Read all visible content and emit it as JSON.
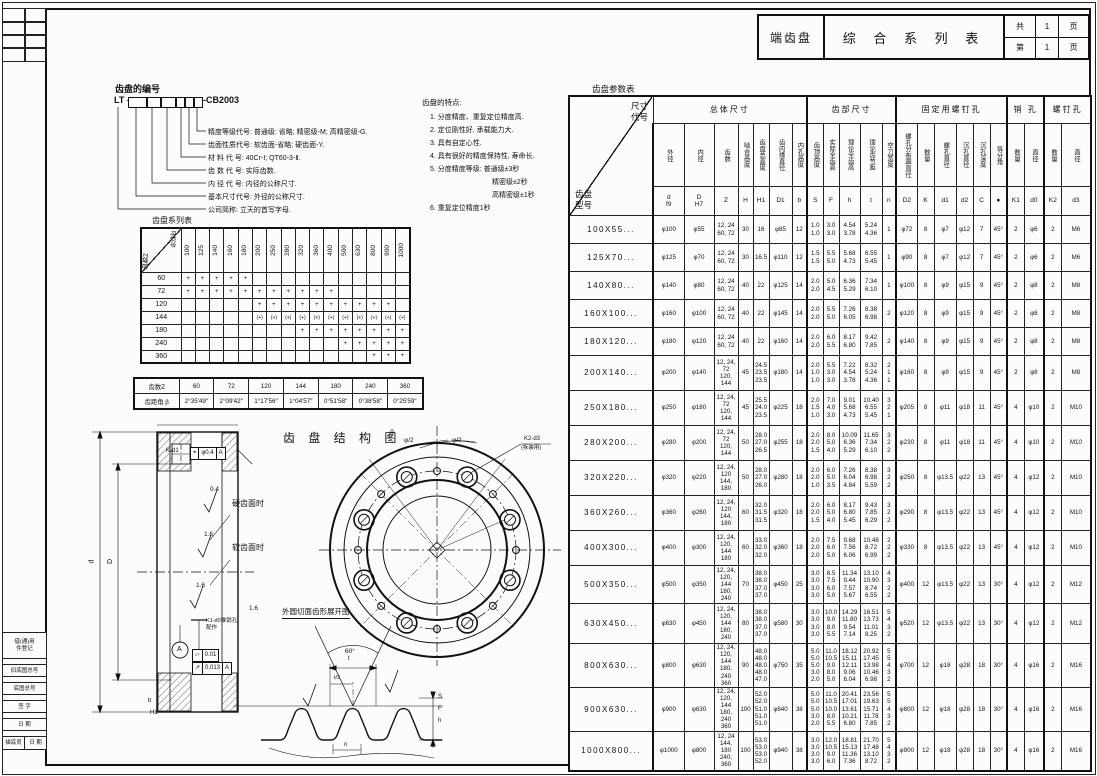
{
  "title_block": {
    "part_name": "端齿盘",
    "title": "综 合 系 列 表",
    "pages_total_prefix": "共",
    "pages_total_num": "1",
    "pages_total_suffix": "页",
    "page_prefix": "第",
    "page_num": "1",
    "page_suffix": "页"
  },
  "numbering": {
    "title": "齿盘的编号",
    "code_prefix": "LT -",
    "code_suffix": "-CB2003",
    "legend": [
      {
        "text": "精度等级代号: 普通级: 省略; 精密级-M; 高精密级-G."
      },
      {
        "text": "齿面性质代号: 软齿面-省略; 硬齿面-Y."
      },
      {
        "text": "材 料 代 号: 40Cr-Ⅰ; QT60-3-Ⅱ."
      },
      {
        "text": "齿 数 代 号: 实际齿数."
      },
      {
        "text": "内 径 代 号: 内径的公称尺寸."
      },
      {
        "text": "基本尺寸代号: 外径的公称尺寸."
      },
      {
        "text": "公司简称: 立天的首写字母."
      }
    ]
  },
  "features": {
    "title": "齿盘的特点:",
    "items": [
      {
        "text": "1. 分度精度、重复定位精度高.",
        "indent": 0
      },
      {
        "text": "2. 定位刚性好, 承载能力大.",
        "indent": 0
      },
      {
        "text": "3. 具有自定心性.",
        "indent": 0
      },
      {
        "text": "4. 具有很好的精度保持性, 寿命长.",
        "indent": 0
      },
      {
        "text": "5. 分度精度等级: 普通级±3秒",
        "indent": 0
      },
      {
        "text": "精密级±2秒",
        "indent": 1
      },
      {
        "text": "高精密级±1秒",
        "indent": 1
      },
      {
        "text": "6. 重复定位精度1秒",
        "indent": 0
      }
    ]
  },
  "series_table": {
    "title": "齿盘系列表",
    "corner_top": "外径d",
    "corner_bottom": "齿数Z",
    "columns": [
      "100",
      "125",
      "140",
      "160",
      "180",
      "200",
      "250",
      "280",
      "320",
      "360",
      "400",
      "500",
      "630",
      "800",
      "900",
      "1000"
    ],
    "rows": [
      {
        "z": "60",
        "marks": [
          "+",
          "+",
          "+",
          "+",
          "+",
          "",
          "",
          "",
          "",
          "",
          "",
          "",
          "",
          "",
          "",
          ""
        ]
      },
      {
        "z": "72",
        "marks": [
          "+",
          "+",
          "+",
          "+",
          "+",
          "+",
          "+",
          "+",
          "+",
          "+",
          "+",
          "",
          "",
          "",
          "",
          ""
        ]
      },
      {
        "z": "120",
        "marks": [
          "",
          "",
          "",
          "",
          "",
          "+",
          "+",
          "+",
          "+",
          "+",
          "+",
          "+",
          "+",
          "+",
          "+",
          ""
        ]
      },
      {
        "z": "144",
        "marks": [
          "",
          "",
          "",
          "",
          "",
          "(+)",
          "(+)",
          "(+)",
          "(+)",
          "(+)",
          "(+)",
          "(+)",
          "(+)",
          "(+)",
          "(+)",
          "(+)"
        ]
      },
      {
        "z": "180",
        "marks": [
          "",
          "",
          "",
          "",
          "",
          "",
          "",
          "",
          "+",
          "+",
          "+",
          "+",
          "+",
          "+",
          "+",
          "+"
        ]
      },
      {
        "z": "240",
        "marks": [
          "",
          "",
          "",
          "",
          "",
          "",
          "",
          "",
          "",
          "",
          "",
          "+",
          "+",
          "+",
          "+",
          "+"
        ]
      },
      {
        "z": "360",
        "marks": [
          "",
          "",
          "",
          "",
          "",
          "",
          "",
          "",
          "",
          "",
          "",
          "",
          "",
          "+",
          "+",
          "+"
        ]
      }
    ]
  },
  "angle_table": {
    "header_label": "齿数Z",
    "row_label": "齿距角 β",
    "columns": [
      "60",
      "72",
      "120",
      "144",
      "180",
      "240",
      "360"
    ],
    "values": [
      "2°35′49″",
      "2°09′42″",
      "1°17′56″",
      "1°04′57″",
      "0°51′58″",
      "0°38′58″",
      "0°25′59″"
    ]
  },
  "structure_fig": {
    "title": "齿 盘 结 构 图",
    "theta": "θ",
    "phi_left": "φ/2",
    "phi_right": "φ/2",
    "callout_line1": "K2-d3",
    "callout_line2": "(拆装用)"
  },
  "side_view": {
    "callout_kd1": "K-d1",
    "pos_tol_sym": "⌖",
    "pos_tol_val": "φ0.4",
    "pos_tol_datum": "A",
    "rough_hard": "0.4",
    "label_hard": "硬齿面时",
    "rough_soft": "1.6",
    "label_soft": "软齿面时",
    "rough_3": "1.6",
    "pin_note_1": "K1-d0锥销孔",
    "pin_note_2": "配作",
    "datum_label": "A",
    "flat_sym": "▱",
    "flat_val": "0.01",
    "runout_sym": "↗",
    "runout_val": "0.013",
    "runout_datum": "A",
    "dim_d": "d",
    "dim_D": "D",
    "dim_b": "b",
    "dim_H1": "H1"
  },
  "development_fig": {
    "title": "外圆切面齿形展开图",
    "rough": "1.6",
    "angle": "60°",
    "dim_t": "t",
    "dim_t2": "t/2",
    "dim_n": "n",
    "dim_S": "S",
    "dim_F": "F",
    "dim_h": "h"
  },
  "param_table": {
    "title": "齿盘参数表",
    "corner_top": "尺寸\n代号",
    "corner_bottom": "齿盘\n型号",
    "groups": [
      {
        "label": "总体尺寸",
        "span": 7
      },
      {
        "label": "齿部尺寸",
        "span": 5
      },
      {
        "label": "固定用螺钉孔",
        "span": 6
      },
      {
        "label": "销 孔",
        "span": 2
      },
      {
        "label": "螺钉孔",
        "span": 2
      }
    ],
    "columns": [
      {
        "name": "外径",
        "sym": "d\nf9",
        "key": "d",
        "w": 31
      },
      {
        "name": "内径",
        "sym": "D\nH7",
        "key": "D",
        "w": 30
      },
      {
        "name": "齿数",
        "sym": "Z",
        "key": "Z",
        "w": 24
      },
      {
        "name": "啮合高度",
        "sym": "H",
        "key": "H",
        "w": 15
      },
      {
        "name": "齿盘总高度",
        "sym": "H1",
        "key": "H1",
        "w": 16
      },
      {
        "name": "齿内缘直径",
        "sym": "D1",
        "key": "D1",
        "w": 23
      },
      {
        "name": "内孔高度",
        "sym": "b",
        "key": "b",
        "w": 15
      },
      {
        "name": "齿顶高度",
        "sym": "S",
        "key": "S",
        "w": 16
      },
      {
        "name": "实际全齿高",
        "sym": "F",
        "key": "F",
        "w": 16
      },
      {
        "name": "理论全齿高",
        "sym": "h",
        "key": "h",
        "w": 21
      },
      {
        "name": "理论齿节距",
        "sym": "t",
        "key": "t",
        "w": 22
      },
      {
        "name": "空刀宽度",
        "sym": "n",
        "key": "n",
        "w": 14
      },
      {
        "name": "螺孔分布圆直径",
        "sym": "D2",
        "key": "D2",
        "w": 21
      },
      {
        "name": "数量",
        "sym": "K",
        "key": "K",
        "w": 17
      },
      {
        "name": "螺孔直径",
        "sym": "d1",
        "key": "d1",
        "w": 22
      },
      {
        "name": "沉孔直径",
        "sym": "d2",
        "key": "d2",
        "w": 17
      },
      {
        "name": "沉孔深度",
        "sym": "C",
        "key": "C",
        "w": 17
      },
      {
        "name": "等分角",
        "sym": "●",
        "key": "ang",
        "w": 17
      },
      {
        "name": "数量",
        "sym": "K1",
        "key": "K1",
        "w": 17
      },
      {
        "name": "直径",
        "sym": "d0",
        "key": "d0",
        "w": 20
      },
      {
        "name": "数量",
        "sym": "K2",
        "key": "K2",
        "w": 17
      },
      {
        "name": "直径",
        "sym": "d3",
        "key": "d3",
        "w": 30
      }
    ],
    "rows": [
      {
        "model": "100X55...",
        "d": "φ100",
        "D": "φ55",
        "Z": "12, 24\n60, 72",
        "H": "30",
        "H1": "16",
        "D1": "φ85",
        "b": "12",
        "S": "1.0\n1.0",
        "F": "3.0\n3.0",
        "h": "4.54\n3.78",
        "t": "5.24\n4.36",
        "n": "1",
        "D2": "φ72",
        "K": "8",
        "d1": "φ7",
        "d2": "φ12",
        "C": "7",
        "ang": "45°",
        "K1": "2",
        "d0": "φ6",
        "K2": "2",
        "d3": "M6"
      },
      {
        "model": "125X70...",
        "d": "φ125",
        "D": "φ70",
        "Z": "12, 24\n60, 72",
        "H": "30",
        "H1": "16.5",
        "D1": "φ110",
        "b": "12",
        "S": "1.5\n1.5",
        "F": "5.5\n5.0",
        "h": "5.68\n4.73",
        "t": "6.55\n5.45",
        "n": "1",
        "D2": "φ90",
        "K": "8",
        "d1": "φ7",
        "d2": "φ12",
        "C": "7",
        "ang": "45°",
        "K1": "2",
        "d0": "φ6",
        "K2": "2",
        "d3": "M6"
      },
      {
        "model": "140X80...",
        "d": "φ140",
        "D": "φ80",
        "Z": "12, 24\n60, 72",
        "H": "40",
        "H1": "22",
        "D1": "φ125",
        "b": "14",
        "S": "2.0\n2.0",
        "F": "5.0\n4.5",
        "h": "6.36\n5.29",
        "t": "7.34\n6.10",
        "n": "1",
        "D2": "φ100",
        "K": "8",
        "d1": "φ9",
        "d2": "φ15",
        "C": "9",
        "ang": "45°",
        "K1": "2",
        "d0": "φ8",
        "K2": "2",
        "d3": "M8"
      },
      {
        "model": "160X100...",
        "d": "φ160",
        "D": "φ100",
        "Z": "12, 24\n60, 72",
        "H": "40",
        "H1": "22",
        "D1": "φ145",
        "b": "14",
        "S": "2.0\n2.0",
        "F": "5.5\n5.0",
        "h": "7.26\n6.05",
        "t": "8.38\n6.98",
        "n": "2",
        "D2": "φ120",
        "K": "8",
        "d1": "φ9",
        "d2": "φ15",
        "C": "9",
        "ang": "45°",
        "K1": "2",
        "d0": "φ8",
        "K2": "2",
        "d3": "M8"
      },
      {
        "model": "180X120...",
        "d": "φ180",
        "D": "φ120",
        "Z": "12, 24\n60, 72",
        "H": "40",
        "H1": "22",
        "D1": "φ160",
        "b": "14",
        "S": "2.0\n2.0",
        "F": "6.0\n5.5",
        "h": "8.17\n6.80",
        "t": "9.42\n7.85",
        "n": "2",
        "D2": "φ140",
        "K": "8",
        "d1": "φ9",
        "d2": "φ15",
        "C": "9",
        "ang": "45°",
        "K1": "2",
        "d0": "φ8",
        "K2": "2",
        "d3": "M8"
      },
      {
        "model": "200X140...",
        "d": "φ200",
        "D": "φ140",
        "Z": "12, 24, 72\n120, 144",
        "H": "45",
        "H1": "24.5\n23.5\n23.5",
        "D1": "φ180",
        "b": "14",
        "S": "2.0\n1.0\n1.0",
        "F": "5.5\n3.0\n3.0",
        "h": "7.22\n4.54\n3.78",
        "t": "8.32\n5.24\n4.36",
        "n": "2\n1\n1",
        "D2": "φ160",
        "K": "8",
        "d1": "φ9",
        "d2": "φ15",
        "C": "9",
        "ang": "45°",
        "K1": "2",
        "d0": "φ8",
        "K2": "2",
        "d3": "M8"
      },
      {
        "model": "250X180...",
        "d": "φ250",
        "D": "φ180",
        "Z": "12, 24, 72\n120, 144",
        "H": "45",
        "H1": "25.5\n24.0\n23.5",
        "D1": "φ225",
        "b": "18",
        "S": "2.0\n1.5\n1.0",
        "F": "7.0\n4.0\n3.0",
        "h": "9.01\n5.68\n4.73",
        "t": "10.40\n6.55\n5.45",
        "n": "3\n2\n1",
        "D2": "φ205",
        "K": "8",
        "d1": "φ11",
        "d2": "φ18",
        "C": "11",
        "ang": "45°",
        "K1": "4",
        "d0": "φ10",
        "K2": "2",
        "d3": "M10"
      },
      {
        "model": "280X200...",
        "d": "φ280",
        "D": "φ200",
        "Z": "12, 24, 72\n120, 144",
        "H": "50",
        "H1": "28.0\n27.0\n26.5",
        "D1": "φ255",
        "b": "18",
        "S": "2.0\n2.0\n1.5",
        "F": "8.0\n5.0\n4.0",
        "h": "10.09\n6.36\n5.29",
        "t": "11.65\n7.34\n6.10",
        "n": "3\n2\n2",
        "D2": "φ230",
        "K": "8",
        "d1": "φ11",
        "d2": "φ18",
        "C": "11",
        "ang": "45°",
        "K1": "4",
        "d0": "φ10",
        "K2": "2",
        "d3": "M10"
      },
      {
        "model": "320X220...",
        "d": "φ320",
        "D": "φ220",
        "Z": "12, 24, 120\n144, 180",
        "H": "50",
        "H1": "28.0\n27.0\n26.0",
        "D1": "φ280",
        "b": "18",
        "S": "2.0\n2.0\n1.0",
        "F": "6.0\n5.0\n3.5",
        "h": "7.26\n6.04\n4.84",
        "t": "8.38\n6.98\n5.59",
        "n": "3\n2\n2",
        "D2": "φ250",
        "K": "8",
        "d1": "φ13.5",
        "d2": "φ22",
        "C": "13",
        "ang": "45°",
        "K1": "4",
        "d0": "φ12",
        "K2": "2",
        "d3": "M10"
      },
      {
        "model": "360X260...",
        "d": "φ360",
        "D": "φ260",
        "Z": "12, 24, 120\n144, 180",
        "H": "60",
        "H1": "32.0\n31.5\n31.5",
        "D1": "φ320",
        "b": "18",
        "S": "2.0\n2.0\n1.5",
        "F": "6.0\n5.0\n4.0",
        "h": "8.17\n6.80\n5.45",
        "t": "9.43\n7.85\n6.29",
        "n": "3\n2\n2",
        "D2": "φ290",
        "K": "8",
        "d1": "φ13.5",
        "d2": "φ22",
        "C": "13",
        "ang": "45°",
        "K1": "4",
        "d0": "φ12",
        "K2": "2",
        "d3": "M10"
      },
      {
        "model": "400X300...",
        "d": "φ400",
        "D": "φ300",
        "Z": "12, 24,\n120, 144\n180",
        "H": "60",
        "H1": "33.0\n32.0\n32.0",
        "D1": "φ360",
        "b": "18",
        "S": "2.0\n2.0\n2.0",
        "F": "7.5\n6.0\n5.0",
        "h": "9.68\n7.56\n6.06",
        "t": "10.48\n8.72\n6.99",
        "n": "2\n2\n2",
        "D2": "φ330",
        "K": "8",
        "d1": "φ13.5",
        "d2": "φ22",
        "C": "13",
        "ang": "45°",
        "K1": "4",
        "d0": "φ12",
        "K2": "2",
        "d3": "M10"
      },
      {
        "model": "500X350...",
        "d": "φ500",
        "D": "φ350",
        "Z": "12, 24,\n120, 144\n180, 240",
        "H": "70",
        "H1": "38.0\n38.0\n37.0\n37.0",
        "D1": "φ450",
        "b": "25",
        "S": "3.0\n3.0\n3.0\n3.0",
        "F": "8.5\n7.5\n6.0\n5.0",
        "h": "11.34\n9.44\n7.57\n5.67",
        "t": "13.10\n10.90\n8.74\n6.55",
        "n": "4\n3\n2\n2",
        "D2": "φ400",
        "K": "12",
        "d1": "φ13.5",
        "d2": "φ22",
        "C": "13",
        "ang": "30°",
        "K1": "4",
        "d0": "φ12",
        "K2": "2",
        "d3": "M12"
      },
      {
        "model": "630X450...",
        "d": "φ630",
        "D": "φ450",
        "Z": "12, 24,\n120, 144\n180, 240",
        "H": "80",
        "H1": "38.0\n38.0\n37.0\n37.0",
        "D1": "φ580",
        "b": "30",
        "S": "3.0\n3.0\n3.0\n3.0",
        "F": "10.0\n9.0\n8.0\n5.5",
        "h": "14.29\n11.80\n9.54\n7.14",
        "t": "16.51\n13.73\n11.01\n8.25",
        "n": "5\n4\n3\n2",
        "D2": "φ520",
        "K": "12",
        "d1": "φ13.5",
        "d2": "φ22",
        "C": "13",
        "ang": "30°",
        "K1": "4",
        "d0": "φ12",
        "K2": "2",
        "d3": "M12"
      },
      {
        "model": "800X630...",
        "d": "φ800",
        "D": "φ630",
        "Z": "12, 24,\n120, 144\n180, 240\n360",
        "H": "90",
        "H1": "48.0\n48.0\n48.0\n48.0\n47.0",
        "D1": "φ750",
        "b": "35",
        "S": "5.0\n5.0\n5.0\n3.0\n2.0",
        "F": "11.0\n10.5\n9.0\n8.0\n5.0",
        "h": "18.12\n15.11\n12.11\n9.06\n6.04",
        "t": "20.92\n17.45\n13.98\n10.46\n6.98",
        "n": "5\n5\n4\n3\n2",
        "D2": "φ700",
        "K": "12",
        "d1": "φ18",
        "d2": "φ28",
        "C": "18",
        "ang": "30°",
        "K1": "4",
        "d0": "φ16",
        "K2": "2",
        "d3": "M16"
      },
      {
        "model": "900X630...",
        "d": "φ900",
        "D": "φ630",
        "Z": "12, 24,\n120, 144\n180, 240\n360",
        "H": "100",
        "H1": "52.0\n52.0\n51.0\n51.0\n51.0",
        "D1": "φ840",
        "b": "38",
        "S": "5.0\n5.0\n5.0\n3.0\n2.0",
        "F": "11.0\n10.5\n10.0\n8.0\n5.5",
        "h": "20.41\n17.01\n13.61\n10.21\n6.80",
        "t": "23.56\n19.63\n15.71\n11.78\n7.85",
        "n": "5\n5\n4\n3\n2",
        "D2": "φ800",
        "K": "12",
        "d1": "φ18",
        "d2": "φ28",
        "C": "18",
        "ang": "30°",
        "K1": "4",
        "d0": "φ16",
        "K2": "2",
        "d3": "M16"
      },
      {
        "model": "1000X800...",
        "d": "φ1000",
        "D": "φ800",
        "Z": "12, 24\n144, 180\n240, 360",
        "H": "100",
        "H1": "53.0\n53.0\n53.0\n52.0",
        "D1": "φ940",
        "b": "38",
        "S": "3.0\n3.0\n3.0\n3.0",
        "F": "12.0\n10.5\n9.0\n6.0",
        "h": "18.81\n15.13\n11.36\n7.36",
        "t": "21.70\n17.48\n13.10\n8.72",
        "n": "5\n4\n3\n2",
        "D2": "φ900",
        "K": "12",
        "d1": "φ18",
        "d2": "φ28",
        "C": "18",
        "ang": "30°",
        "K1": "4",
        "d0": "φ16",
        "K2": "2",
        "d3": "M16"
      }
    ]
  },
  "margin": {
    "boxes": [
      "借(通)用\n件登记",
      "旧底图总号",
      "底图总号",
      "签  字",
      "日  期"
    ],
    "last_left": "描底员",
    "last_right": "日 期"
  }
}
